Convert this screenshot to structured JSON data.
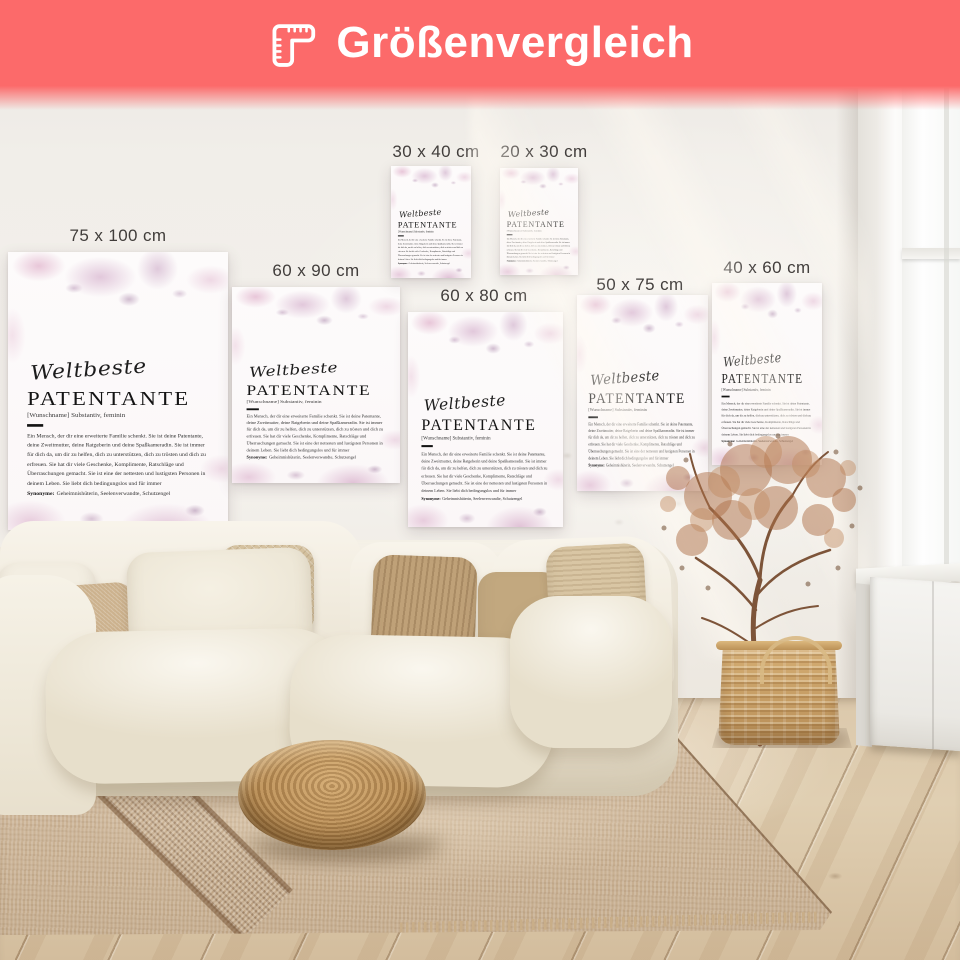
{
  "header": {
    "title": "Größenvergleich",
    "icon": "corner-ruler-icon",
    "background_color": "#FC6A6A",
    "text_color": "#FFFFFF"
  },
  "sizes": [
    {
      "label": "75 x 100 cm"
    },
    {
      "label": "60 x 90 cm"
    },
    {
      "label": "30 x 40 cm"
    },
    {
      "label": "20 x 30 cm"
    },
    {
      "label": "60 x 80 cm"
    },
    {
      "label": "50 x 75 cm"
    },
    {
      "label": "40 x 60 cm"
    }
  ],
  "poster_design": {
    "script_word": "Weltbeste",
    "title": "PATENTANTE",
    "meta": "[Wunschname] Substantiv, feminin",
    "definition": "Ein Mensch, der dir eine erweiterte Familie schenkt. Sie ist deine Patentante, deine Zweitmutter, deine Ratgeberin und deine Spaßkameradin. Sie ist immer für dich da, um dir zu helfen, dich zu unterstützen, dich zu trösten und dich zu erfreuen. Sie hat dir viele Geschenke, Komplimente, Ratschläge und Überraschungen gemacht. Sie ist eine der nettesten und lustigsten Personen in deinem Leben. Sie liebt dich bedingungslos und für immer",
    "synonyms_label": "Synonyme:",
    "synonyms": "Geheimnishüterin, Seelenverwandte, Schutzengel",
    "paper_color": "#FBF8F8",
    "floral_pink": "#DBAFC9",
    "text_color": "#1E1E1E"
  },
  "scene": {
    "palette": {
      "wall": "#F0EDE8",
      "sofa": "#F2EDE1",
      "pillow_beige": "#CCB28E",
      "pillow_tan": "#BFA178",
      "pouf_rattan": "#B78A51",
      "rug": "#CDB499",
      "floor_wood": "#DCC9AC",
      "basket": "#C9A266",
      "dried_plant": "#B0744E",
      "window_light": "#FDFDFC"
    }
  }
}
